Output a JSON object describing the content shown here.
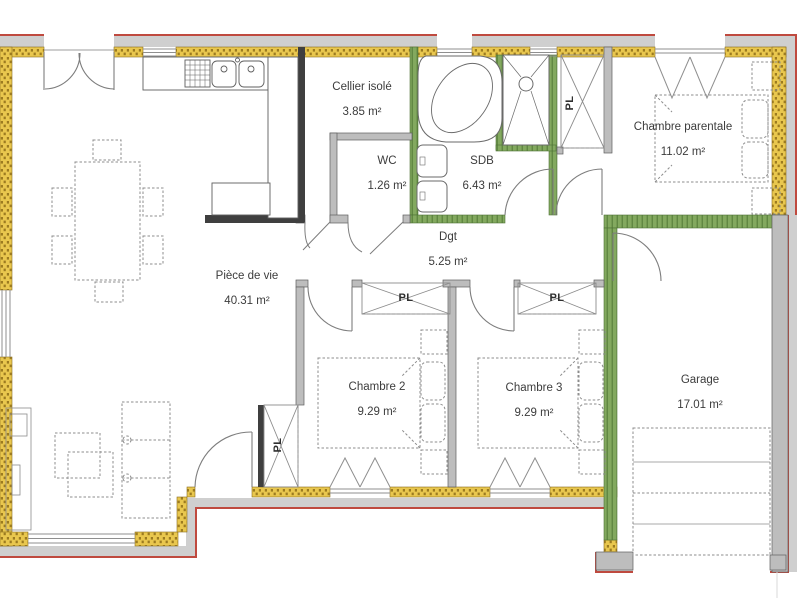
{
  "plan": {
    "type": "floor-plan",
    "units": "m²"
  },
  "rooms": [
    {
      "id": "cellier",
      "name": "Cellier isolé",
      "area": "3.85 m²"
    },
    {
      "id": "wc",
      "name": "WC",
      "area": "1.26 m²"
    },
    {
      "id": "sdb",
      "name": "SDB",
      "area": "6.43 m²"
    },
    {
      "id": "parentale",
      "name": "Chambre parentale",
      "area": "11.02 m²"
    },
    {
      "id": "dgt",
      "name": "Dgt",
      "area": "5.25 m²"
    },
    {
      "id": "piece",
      "name": "Pièce de vie",
      "area": "40.31 m²"
    },
    {
      "id": "chambre2",
      "name": "Chambre 2",
      "area": "9.29 m²"
    },
    {
      "id": "chambre3",
      "name": "Chambre 3",
      "area": "9.29 m²"
    },
    {
      "id": "garage",
      "name": "Garage",
      "area": "17.01 m²"
    }
  ],
  "closets": {
    "label": "PL"
  },
  "colors": {
    "exterior_wall": "#e9c74e",
    "exterior_wall_hatch": "#9c7b20",
    "insulated_wall": "#83a95f",
    "insulated_wall_hatch": "#5d8440",
    "concrete_wall": "#bdbdbd",
    "roof_overhang": "#cfcfcf",
    "outline_red": "#bf4a3f"
  }
}
